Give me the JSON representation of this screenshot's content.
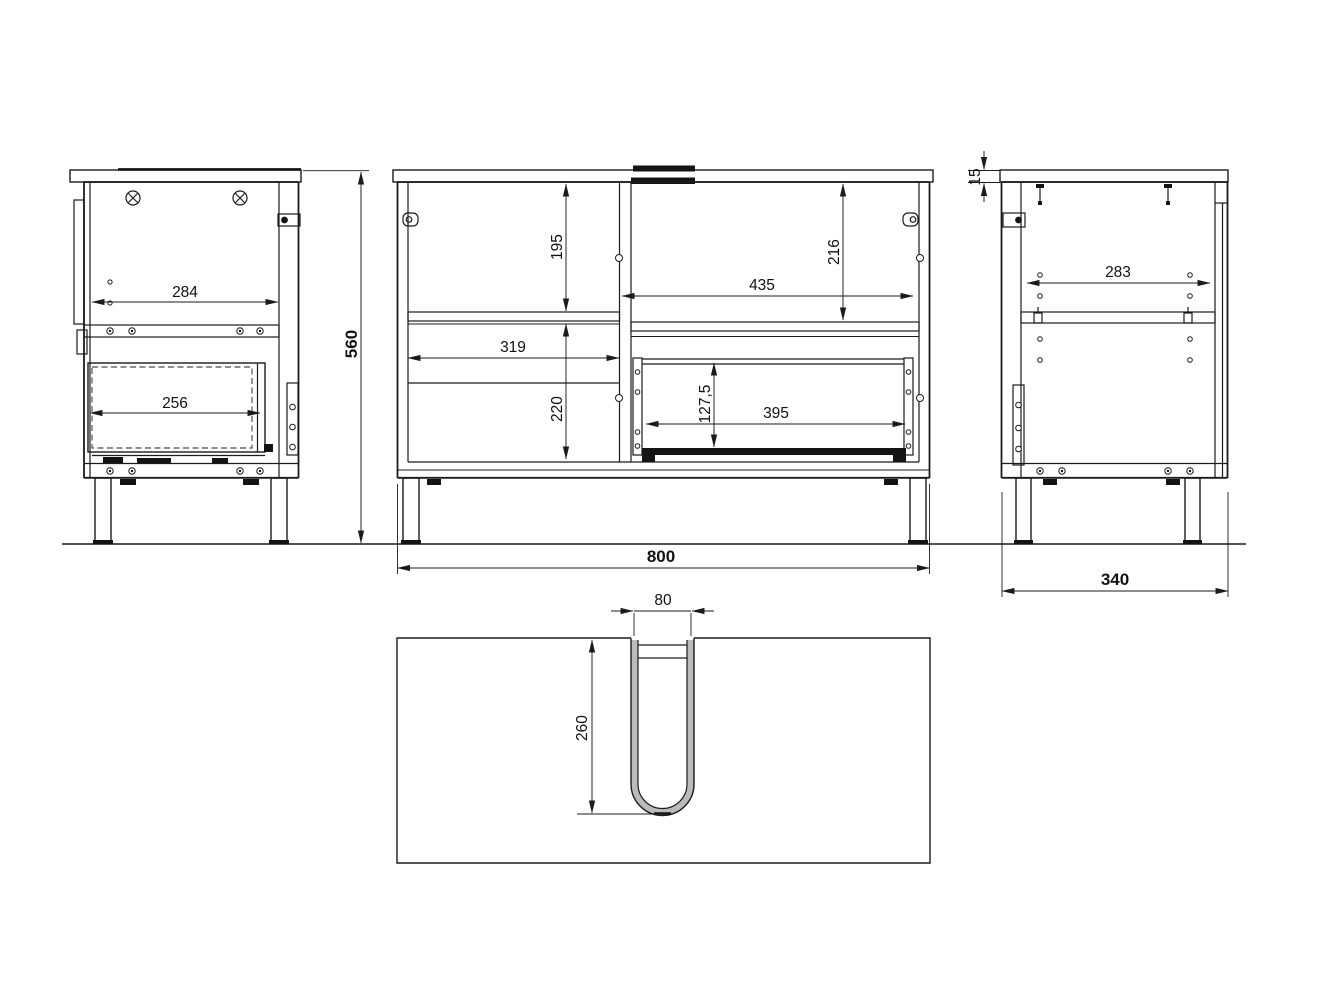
{
  "drawing": {
    "background_color": "#ffffff",
    "line_color": "#1b1b1b",
    "views": {
      "side_left": {
        "label": "left side view",
        "dims": {
          "inner_width": "284",
          "drawer_inner_depth": "256"
        }
      },
      "front": {
        "label": "front view",
        "dims": {
          "overall_height": "560",
          "overall_width": "800",
          "left_upper_height": "195",
          "left_inner_width": "319",
          "left_lower_height": "220",
          "right_upper_height": "216",
          "right_inner_width": "435",
          "drawer_front_height": "127,5",
          "drawer_inner_width": "395"
        }
      },
      "side_right": {
        "label": "right side view",
        "dims": {
          "countertop_thickness": "15",
          "inner_width": "283",
          "overall_depth": "340"
        }
      },
      "bottom": {
        "label": "bottom view",
        "dims": {
          "pipe_cutout_width": "80",
          "pipe_cutout_depth": "260"
        }
      }
    }
  }
}
